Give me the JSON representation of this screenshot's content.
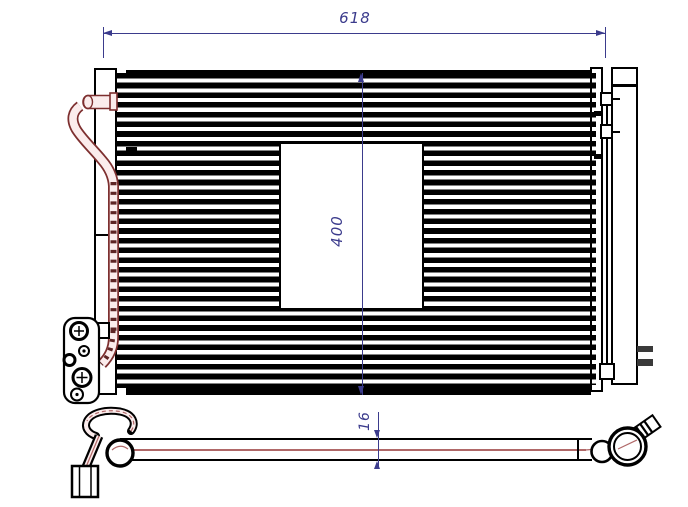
{
  "drawing": {
    "kind": "condenser-technical-drawing",
    "dims": {
      "width": "618",
      "height": "400",
      "thickness": "16"
    },
    "colors": {
      "dimension": "#3b3b8c",
      "outline": "#000000",
      "pipe_outline": "#7d2f2f",
      "pipe_fill": "#fbecec",
      "pipe_centerline": "#b06868"
    }
  }
}
